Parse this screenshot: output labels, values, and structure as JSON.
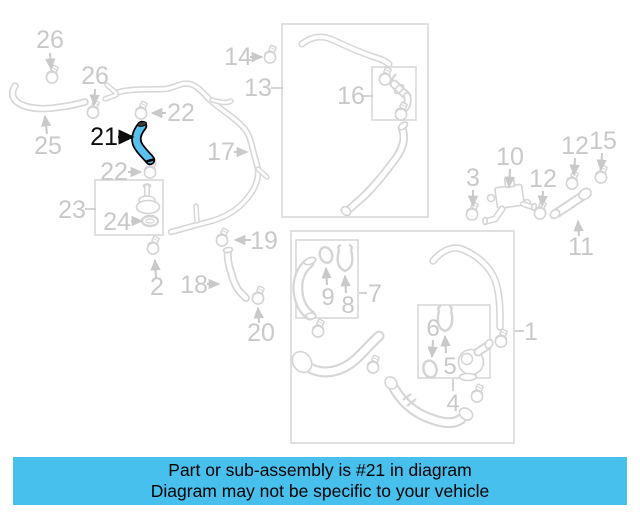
{
  "diagram": {
    "title": "parts-diagram",
    "highlighted_part": "21",
    "labels": {
      "n26a": "26",
      "n25": "25",
      "n26b": "26",
      "n21": "21",
      "n22a": "22",
      "n22b": "22",
      "n23": "23",
      "n24": "24",
      "n2": "2",
      "n17": "17",
      "n14": "14",
      "n13": "13",
      "n16": "16",
      "n19": "19",
      "n18": "18",
      "n20": "20",
      "n3": "3",
      "n10": "10",
      "n12a": "12",
      "n12b": "12",
      "n15": "15",
      "n11": "11",
      "n1": "1",
      "n7": "7",
      "n9": "9",
      "n8": "8",
      "n6": "6",
      "n5": "5",
      "n4": "4"
    },
    "colors": {
      "highlight_fill": "#58c0ee",
      "highlight_outline": "#000000",
      "diagram_gray": "#d6d6d6",
      "label_gray": "#c9c9c9",
      "banner_bg": "#47c0ee",
      "banner_text": "#000000"
    }
  },
  "banner": {
    "line1": "Part or sub-assembly is #21 in diagram",
    "line2": "Diagram may not be specific to your vehicle"
  }
}
